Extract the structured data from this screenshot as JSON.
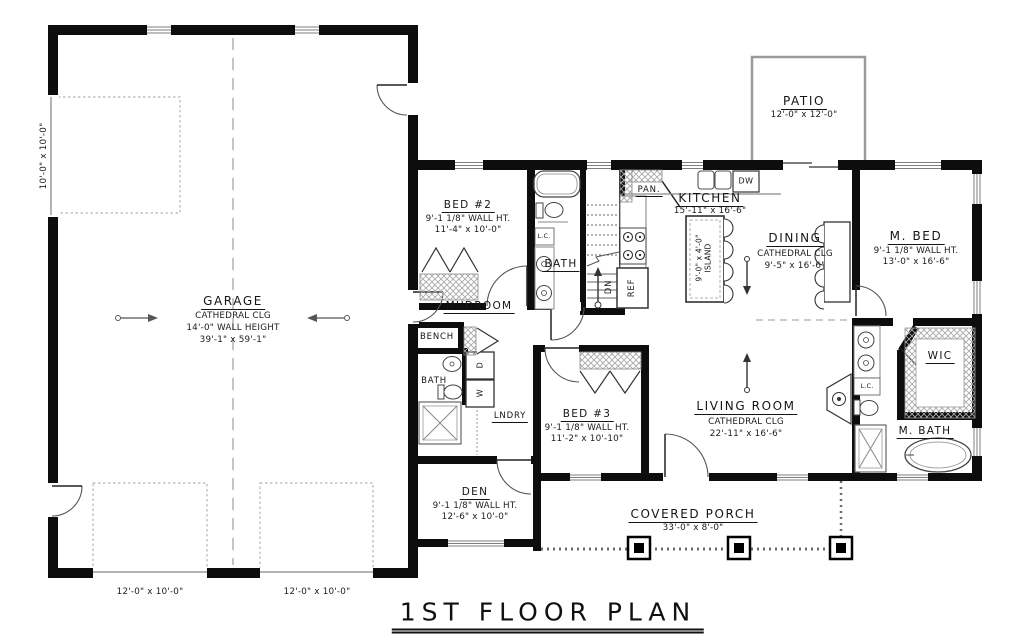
{
  "title": "1ST FLOOR PLAN",
  "rooms": {
    "garage": {
      "name": "GARAGE",
      "ceiling": "CATHEDRAL CLG",
      "wall": "14'-0\" WALL HEIGHT",
      "size": "39'-1\" x 59'-1\""
    },
    "bed2": {
      "name": "BED #2",
      "wall": "9'-1 1/8\" WALL HT.",
      "size": "11'-4\" x 10'-0\""
    },
    "bed3": {
      "name": "BED #3",
      "wall": "9'-1 1/8\" WALL HT.",
      "size": "11'-2\" x 10'-10\""
    },
    "den": {
      "name": "DEN",
      "wall": "9'-1 1/8\" WALL HT.",
      "size": "12'-6\" x 10'-0\""
    },
    "mbed": {
      "name": "M. BED",
      "wall": "9'-1 1/8\" WALL HT.",
      "size": "13'-0\" x 16'-6\""
    },
    "living": {
      "name": "LIVING ROOM",
      "ceiling": "CATHEDRAL CLG",
      "size": "22'-11\" x 16'-6\""
    },
    "dining": {
      "name": "DINING",
      "ceiling": "CATHEDRAL CLG",
      "size": "9'-5\" x 16'-6\""
    },
    "kitchen": {
      "name": "KITCHEN",
      "size": "15'-11\" x 16'-6\""
    },
    "patio": {
      "name": "PATIO",
      "size": "12'-0\" x 12'-0\""
    },
    "porch": {
      "name": "COVERED PORCH",
      "size": "33'-0\" x 8'-0\""
    },
    "mudroom": {
      "name": "MUDROOM"
    },
    "bath2": {
      "name": "BATH"
    },
    "half_bath": {
      "name": "BATH"
    },
    "mbath": {
      "name": "M. BATH"
    },
    "wic": {
      "name": "WIC"
    },
    "laundry": {
      "name": "LNDRY"
    },
    "bench": {
      "name": "BENCH"
    },
    "pantry": {
      "name": "PAN."
    }
  },
  "fixtures": {
    "dishwasher": "DW",
    "refrigerator": "REF",
    "stairs_down": "DN",
    "washer": "W",
    "dryer": "D",
    "linen_closet": "L.C.",
    "island_size": "9'-0\" x 4'-0\"",
    "island": "ISLAND"
  },
  "dimensions": {
    "side_garage_door": "10'-0\" x 10'-0\"",
    "left_garage_door": "12'-0\" x 10'-0\"",
    "right_garage_door": "12'-0\" x 10'-0\""
  }
}
